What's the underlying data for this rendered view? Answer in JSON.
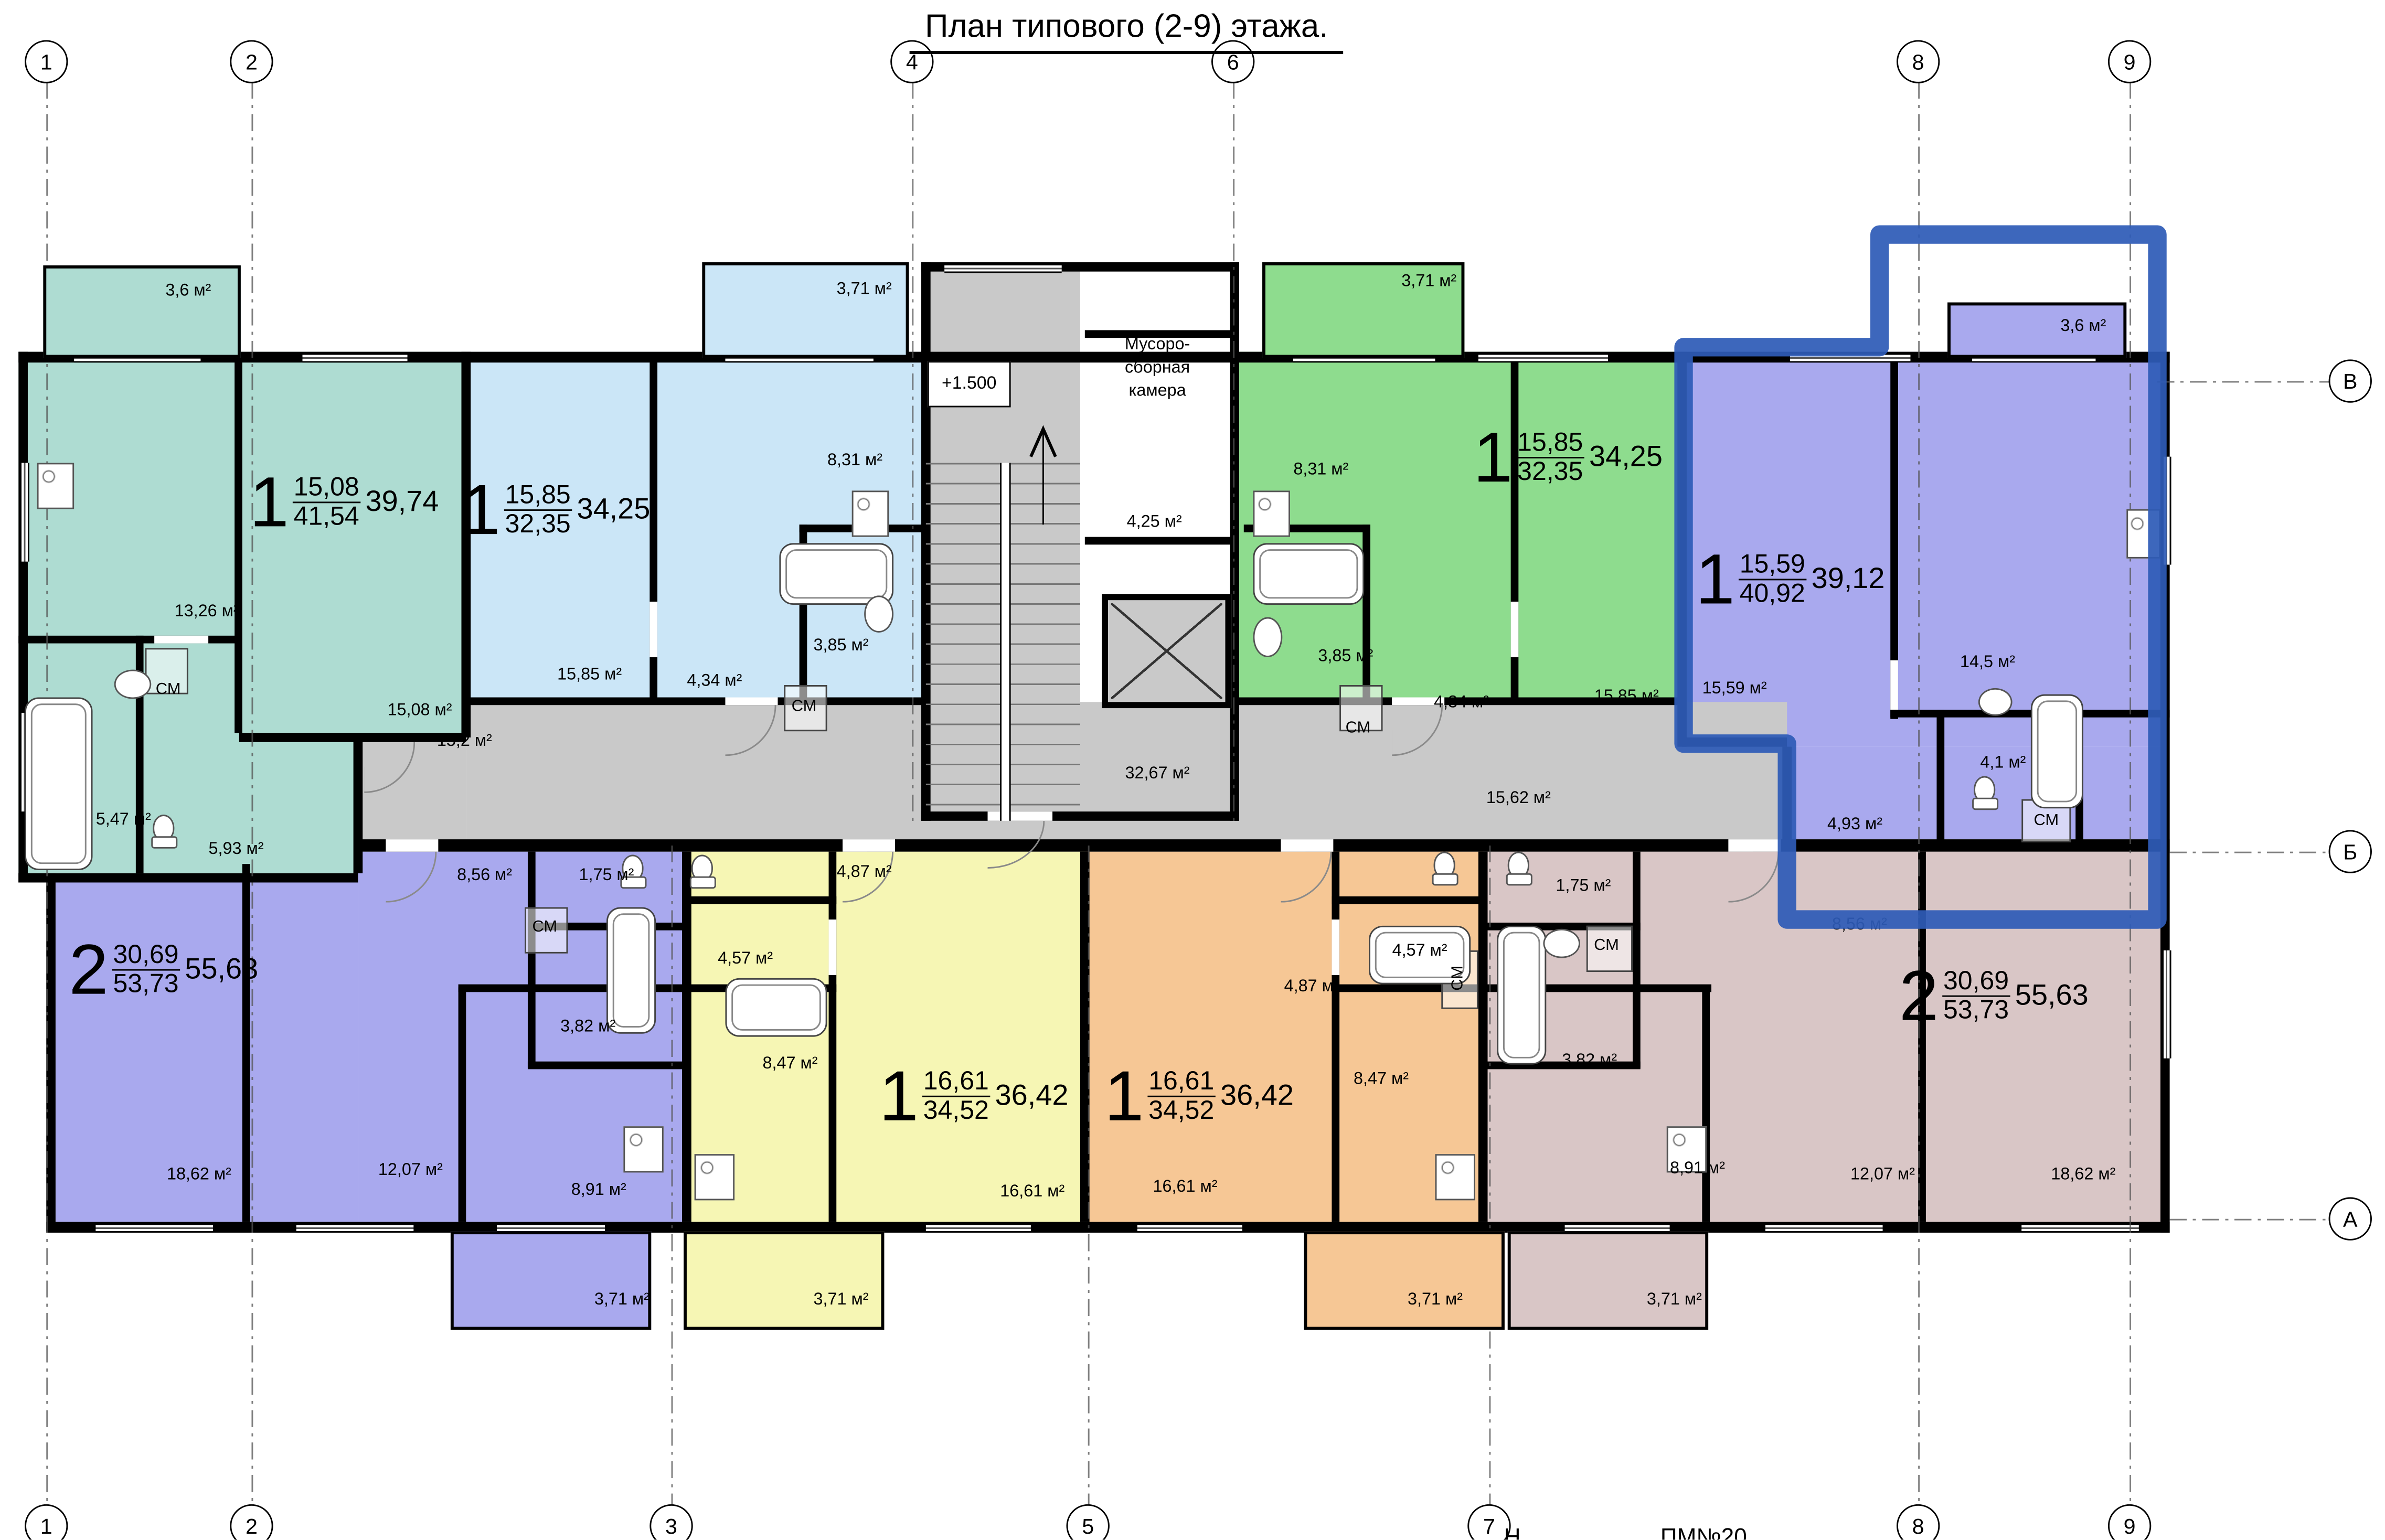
{
  "title": "План типового (2-9) этажа.",
  "axes": {
    "top": [
      {
        "label": "1"
      },
      {
        "label": "2"
      },
      {
        "label": "4"
      },
      {
        "label": "6"
      },
      {
        "label": "8"
      },
      {
        "label": "9"
      }
    ],
    "bottom": [
      {
        "label": "1"
      },
      {
        "label": "2"
      },
      {
        "label": "3"
      },
      {
        "label": "5"
      },
      {
        "label": "7"
      },
      {
        "label": "8"
      },
      {
        "label": "9"
      }
    ],
    "right": [
      {
        "label": "В"
      },
      {
        "label": "Б"
      },
      {
        "label": "А"
      }
    ]
  },
  "core": {
    "elevation": "+1.500",
    "trash_line1": "Мусоро-",
    "trash_line2": "сборная",
    "trash_line3": "камера",
    "trash_area": "4,25 м²"
  },
  "corridor": {
    "left": "15,2 м²",
    "center": "32,67 м²",
    "right": "15,62 м²"
  },
  "apartments": {
    "teal": {
      "type": "1",
      "living": "15,08",
      "total": "41,54",
      "overall": "39,74",
      "rooms": {
        "balcony": "3,6 м²",
        "kitchen": "13,26 м²",
        "living": "15,08 м²",
        "bath": "5,47 м²",
        "hall": "5,93 м²",
        "wm": "СМ"
      }
    },
    "lightblue": {
      "type": "1",
      "living": "15,85",
      "total": "32,35",
      "overall": "34,25",
      "rooms": {
        "balcony": "3,71 м²",
        "kitchen": "8,31 м²",
        "living": "15,85 м²",
        "hall": "4,34 м²",
        "bath": "3,85 м²",
        "wm": "СМ"
      }
    },
    "green": {
      "type": "1",
      "living": "15,85",
      "total": "32,35",
      "overall": "34,25",
      "rooms": {
        "balcony": "3,71 м²",
        "kitchen": "8,31 м²",
        "living": "15,85 м²",
        "hall": "4,34 м²",
        "bath": "3,85 м²",
        "wm": "СМ"
      }
    },
    "violet": {
      "type": "1",
      "living": "15,59",
      "total": "40,92",
      "overall": "39,12",
      "rooms": {
        "balcony": "3,6 м²",
        "living": "15,59 м²",
        "kitchen": "14,5 м²",
        "hall": "4,93 м²",
        "bath": "4,1 м²",
        "wm": "СМ"
      }
    },
    "purple2": {
      "type": "2",
      "living": "30,69",
      "total": "53,73",
      "overall": "55,63",
      "rooms": {
        "bedroom": "18,62 м²",
        "bedroom2": "12,07 м²",
        "kitchen": "8,91 м²",
        "hall": "8,56 м²",
        "wc": "1,75 м²",
        "bath": "3,82 м²",
        "wm": "СМ",
        "balcony": "3,71 м²"
      }
    },
    "yellow": {
      "type": "1",
      "living": "16,61",
      "total": "34,52",
      "overall": "36,42",
      "rooms": {
        "living": "16,61 м²",
        "kitchen": "8,47 м²",
        "bath": "4,57 м²",
        "hall": "4,87 м²",
        "balcony": "3,71 м²"
      }
    },
    "orange": {
      "type": "1",
      "living": "16,61",
      "total": "34,52",
      "overall": "36,42",
      "rooms": {
        "living": "16,61 м²",
        "kitchen": "8,47 м²",
        "bath": "4,57 м²",
        "hall": "4,87 м²",
        "wm": "СМ",
        "balcony": "3,71 м²"
      }
    },
    "beige": {
      "type": "2",
      "living": "30,69",
      "total": "53,73",
      "overall": "55,63",
      "rooms": {
        "bedroom": "18,62 м²",
        "bedroom2": "12,07 м²",
        "kitchen": "8,91 м²",
        "hall": "8,56 м²",
        "wc": "1,75 м²",
        "bath": "3,82 м²",
        "wm": "СМ",
        "balcony": "3,71 м²"
      }
    }
  },
  "footer": {
    "left_fragment": "Н",
    "stamp": "ПМ№20"
  },
  "colors": {
    "teal": "#aedcd2",
    "lightblue": "#cbe6f7",
    "green": "#8edc8e",
    "violet": "#a9a9ee",
    "yellow": "#f6f6b4",
    "orange": "#f6c795",
    "beige": "#d9c6c6",
    "corridor": "#c9c9c9",
    "highlight": "#2e5bb7"
  }
}
